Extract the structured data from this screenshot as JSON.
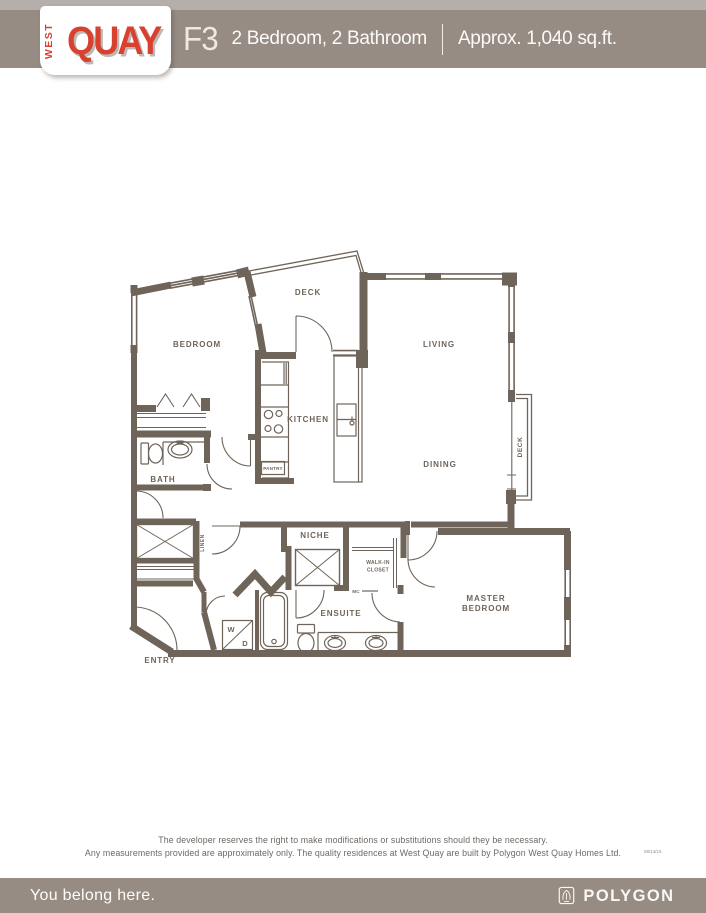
{
  "header": {
    "plan_code": "F3",
    "plan_desc": "2 Bedroom, 2 Bathroom",
    "plan_area": "Approx. 1,040 sq.ft.",
    "bar_color": "#968c84",
    "strip_color": "#b5aeaa"
  },
  "logo": {
    "west": "WEST",
    "quay": "QUAY",
    "red": "#d8412f"
  },
  "floorplan": {
    "wall_color": "#6f6459",
    "labels": {
      "bedroom": "BEDROOM",
      "deck_top": "DECK",
      "living": "LIVING",
      "kitchen": "KITCHEN",
      "pantry": "PANTRY",
      "bath": "BATH",
      "dining": "DINING",
      "deck_right": "DECK",
      "niche": "NICHE",
      "linen": "LINEN",
      "walkin_line1": "WALK-IN",
      "walkin_line2": "CLOSET",
      "mc": "MC",
      "ensuite": "ENSUITE",
      "master_line1": "MASTER",
      "master_line2": "BEDROOM",
      "entry": "ENTRY",
      "washer": "W",
      "dryer": "D"
    }
  },
  "disclaimer": {
    "line1": "The developer reserves the right to make modifications or substitutions should they be necessary.",
    "line2": "Any measurements provided are approximately only. The quality residences at West Quay are built by Polygon West Quay Homes Ltd.",
    "rev_code": "08/13/15"
  },
  "footer": {
    "tagline": "You belong here.",
    "brand": "POLYGON",
    "bar_color": "#968c84"
  }
}
